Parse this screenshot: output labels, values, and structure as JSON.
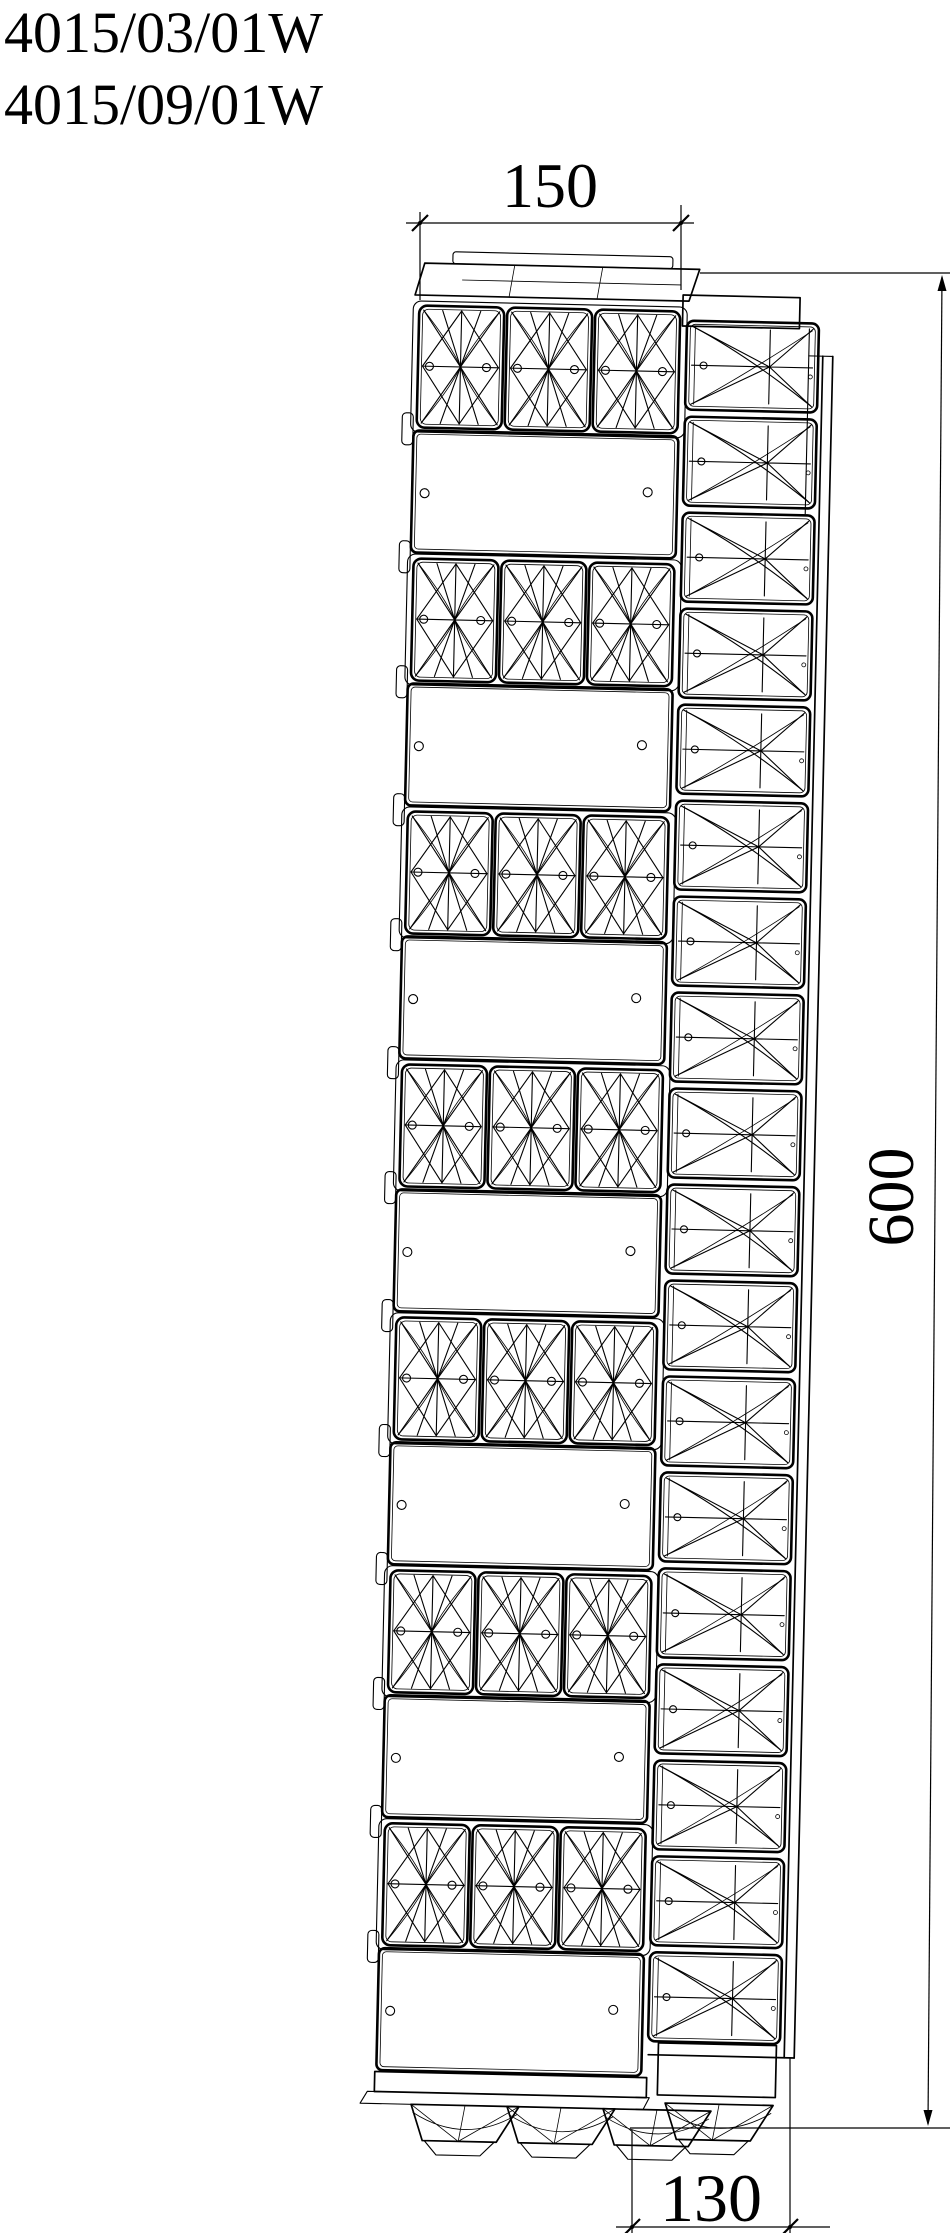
{
  "header": {
    "models": [
      "4015/03/01W",
      "4015/09/01W"
    ]
  },
  "dimensions": {
    "width": "150",
    "height": "600",
    "depth": "130"
  },
  "style": {
    "line_color": "#000000",
    "background": "#ffffff"
  }
}
